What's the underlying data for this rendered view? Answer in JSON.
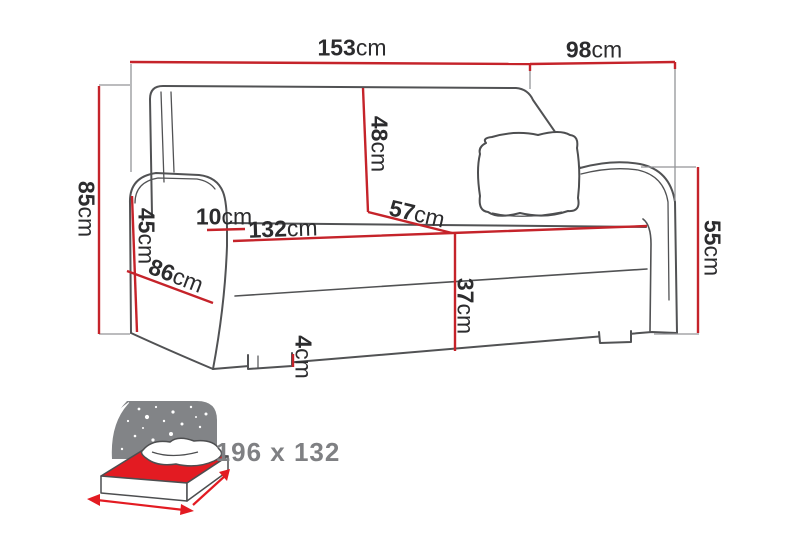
{
  "diagram": {
    "title": "sofa-dimension-diagram",
    "unit_system": "cm"
  },
  "dimensions": {
    "overall_width": {
      "value": "153",
      "unit": "cm"
    },
    "overall_depth": {
      "value": "98",
      "unit": "cm"
    },
    "overall_height": {
      "value": "85",
      "unit": "cm"
    },
    "backrest_height": {
      "value": "48",
      "unit": "cm"
    },
    "arm_front_height": {
      "value": "45",
      "unit": "cm"
    },
    "arm_top_width": {
      "value": "10",
      "unit": "cm"
    },
    "seat_width": {
      "value": "132",
      "unit": "cm"
    },
    "seat_depth": {
      "value": "57",
      "unit": "cm"
    },
    "arm_depth": {
      "value": "86",
      "unit": "cm"
    },
    "arm_height": {
      "value": "55",
      "unit": "cm"
    },
    "seat_height": {
      "value": "37",
      "unit": "cm"
    },
    "leg_height": {
      "value": "4",
      "unit": "cm"
    }
  },
  "sleeping_area": {
    "label": "196 x 132",
    "icon": "sofa-bed-sleeping-area-icon"
  },
  "colors": {
    "dimension_line": "#c5232a",
    "outline_gray": "#515254",
    "extension_gray": "#939497",
    "label_text": "#2c2c2e",
    "sleeping_text": "#7f8083",
    "bed_red": "#e31b22",
    "night_sky_gray": "#828487",
    "background": "#ffffff"
  }
}
